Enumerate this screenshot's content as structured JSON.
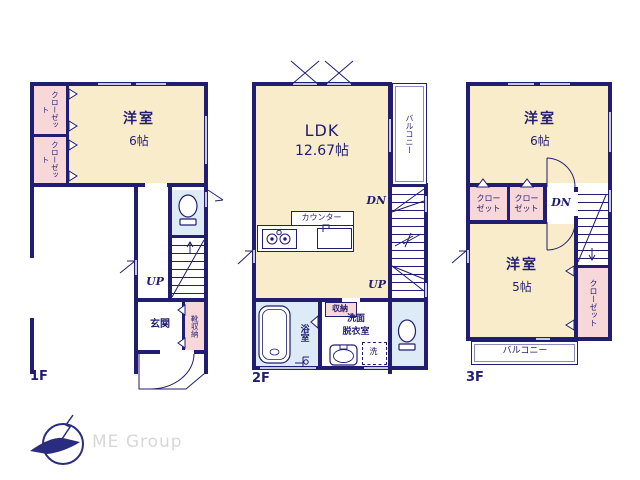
{
  "colors": {
    "wall": "#211d70",
    "room_cream": "#f8ecca",
    "closet_pink": "#f8d7d9",
    "wet_blue": "#dcebf6",
    "window_gray": "#c6c9dd",
    "logo_gray": "#d8d8d8"
  },
  "f1": {
    "floor_label": "1F",
    "room_name": "洋室",
    "room_size": "6帖",
    "closet_a": "クローゼット",
    "closet_b": "クローゼット",
    "entrance": "玄関",
    "shoe_storage": "靴収納",
    "up_label": "UP"
  },
  "f2": {
    "floor_label": "2F",
    "ldk_name": "LDK",
    "ldk_size": "12.67帖",
    "balcony": "バルコニー",
    "counter": "カウンター",
    "dn_label": "DN",
    "up_label": "UP",
    "storage": "収納",
    "bath": "浴室",
    "washroom_line1": "洗面",
    "washroom_line2": "脱衣室",
    "washer": "洗"
  },
  "f3": {
    "floor_label": "3F",
    "room6_name": "洋室",
    "room6_size": "6帖",
    "closet_a": "クローゼット",
    "closet_b": "クローゼット",
    "dn_label": "DN",
    "room5_name": "洋室",
    "room5_size": "5帖",
    "closet_c": "クローゼット",
    "balcony": "バルコニー"
  },
  "logo": {
    "text": "ME Group"
  }
}
